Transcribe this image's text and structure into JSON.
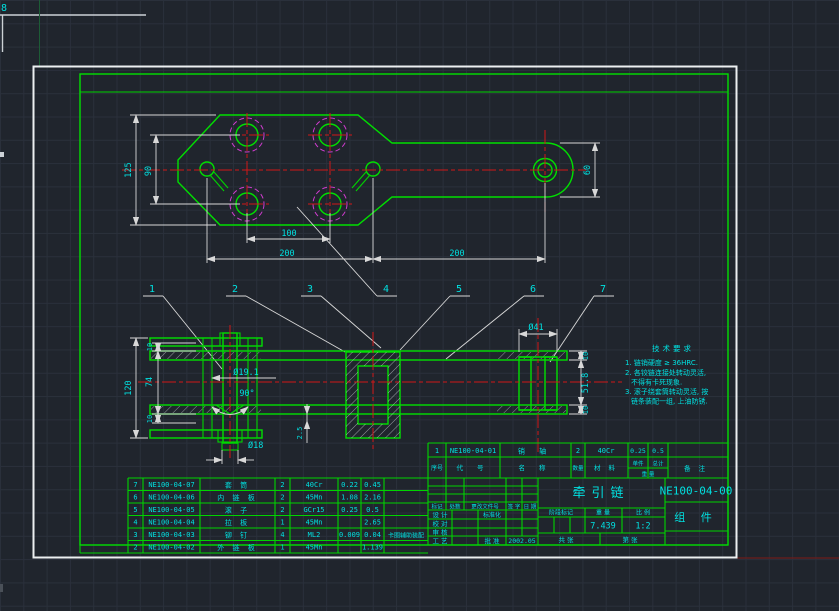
{
  "canvas": {
    "bg": "#20252d",
    "grid": "#2a303b",
    "green": "#00d400",
    "cyan": "#00e0e0",
    "red": "#d01818",
    "magenta": "#cf3ccf",
    "white": "#d8d8d8"
  },
  "artifacts": {
    "corner_glyph": "8"
  },
  "top_view": {
    "dims": {
      "height": "125",
      "hole_span": "90",
      "hole_pitch": "100",
      "pitch_left": "200",
      "pitch_right": "200",
      "bar_width": "60"
    }
  },
  "section_view": {
    "dims": {
      "overall": "120",
      "inner": "74",
      "plate_top": "10",
      "plate_bottom": "10",
      "hole_dia": "Ø19.1",
      "angle": "90°",
      "pin_dia": "Ø18",
      "gap": "2.5",
      "sleeve_od": "Ø41",
      "sleeve_top": "10",
      "sleeve_len": "51.8",
      "sleeve_bottom": "10"
    }
  },
  "balloons": [
    "1",
    "2",
    "3",
    "4",
    "5",
    "6",
    "7"
  ],
  "notes": {
    "title": "技术要求",
    "lines": [
      "1. 链销硬度 ≥ 36HRC.",
      "2. 各铰链连接处转动灵活,",
      "   不得有卡死现象.",
      "3. 滚子绕套筒转动灵活, 按",
      "   链条装配一组, 上油防锈."
    ]
  },
  "bom": {
    "rows": [
      {
        "seq": "7",
        "code": "NE100-04-07",
        "name": "套  筒",
        "qty": "2",
        "material": "40Cr",
        "unit": "0.22",
        "total": "0.45",
        "note": ""
      },
      {
        "seq": "6",
        "code": "NE100-04-06",
        "name": "内 链 板",
        "qty": "2",
        "material": "45Mn",
        "unit": "1.08",
        "total": "2.16",
        "note": ""
      },
      {
        "seq": "5",
        "code": "NE100-04-05",
        "name": "滚  子",
        "qty": "2",
        "material": "GCr15",
        "unit": "0.25",
        "total": "0.5",
        "note": ""
      },
      {
        "seq": "4",
        "code": "NE100-04-04",
        "name": "拉  板",
        "qty": "1",
        "material": "45Mn",
        "unit": "",
        "total": "2.65",
        "note": ""
      },
      {
        "seq": "3",
        "code": "NE100-04-03",
        "name": "铆  钉",
        "qty": "4",
        "material": "ML2",
        "unit": "0.009",
        "total": "0.04",
        "note": "卡圈辅助装配"
      },
      {
        "seq": "2",
        "code": "NE100-04-02",
        "name": "外 链 板",
        "qty": "1",
        "material": "45Mn",
        "unit": "",
        "total": "1.139",
        "note": ""
      }
    ]
  },
  "strip": {
    "row": {
      "seq": "1",
      "code": "NE100-04-01",
      "name": "销  轴",
      "qty": "2",
      "material": "40Cr",
      "unit": "0.25",
      "total": "0.5"
    },
    "headers": {
      "seq": "序号",
      "code": "代  号",
      "name": "名  称",
      "qty": "数量",
      "material": "材  料",
      "unit": "单件",
      "total": "总计",
      "weight": "重  量",
      "note": "备  注"
    }
  },
  "titleblock": {
    "drawing_number": "NE100-04-00",
    "part_type": "组  件",
    "title": "牵引链",
    "weight_value": "7.439",
    "scale_value": "1:2",
    "date": "2002.05",
    "labels": {
      "stage": "阶段标记",
      "weight": "重 量",
      "scale": "比 例",
      "sheets_total": "共  张",
      "sheet_no": "第  张",
      "mark": "标记",
      "count": "处数",
      "change_doc": "更改文件号",
      "sign": "签 字",
      "date_lbl": "日 期",
      "design": "设 计",
      "check": "校 对",
      "review": "审 核",
      "process": "工 艺",
      "standardize": "标准化",
      "approve": "批 准"
    }
  }
}
